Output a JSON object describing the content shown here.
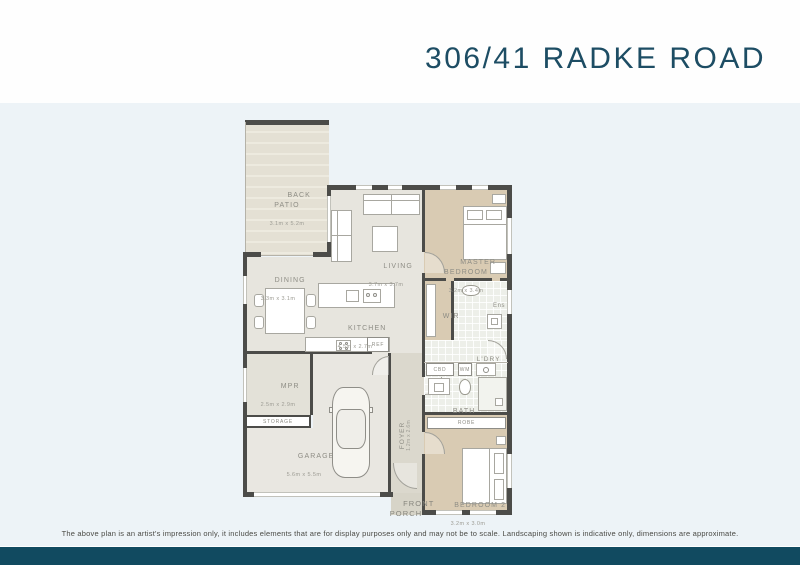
{
  "title": "306/41 RADKE ROAD",
  "disclaimer": "The above plan is an artist's impression only, it includes elements that are for display purposes only and may not be to scale. Landscaping shown is indicative only, dimensions are approximate.",
  "colors": {
    "accent_title": "#1d4d64",
    "footer_bar": "#114a60",
    "page_background": "#fefefe",
    "plan_background": "#edf3f7",
    "wall": "#4c4c49",
    "floor": "#e7e5de",
    "carpet": "#d9cbb3",
    "tile": "#edefe9",
    "deck": "#e4e0d4"
  },
  "rooms": {
    "back_patio": {
      "label": "BACK\nPATIO",
      "dims": "3.1m x 5.2m"
    },
    "living": {
      "label": "LIVING",
      "dims": "3.7m x 3.7m"
    },
    "dining": {
      "label": "DINING",
      "dims": "3.3m x 3.1m"
    },
    "kitchen": {
      "label": "KITCHEN",
      "dims": "4.5m x 2.7m"
    },
    "master_bedroom": {
      "label": "MASTER\nBEDROOM",
      "dims": "3.2m x 3.4m"
    },
    "wir": {
      "label": "WIR"
    },
    "ens": {
      "label": "Ens"
    },
    "ldry": {
      "label": "L'DRY"
    },
    "cbd": {
      "label": "CBD"
    },
    "wm": {
      "label": "WM"
    },
    "bath": {
      "label": "BATH"
    },
    "ref": {
      "label": "REF"
    },
    "mpr": {
      "label": "MPR",
      "dims": "2.5m x 2.9m"
    },
    "storage": {
      "label": "STORAGE"
    },
    "garage": {
      "label": "GARAGE",
      "dims": "5.6m x 5.5m"
    },
    "foyer": {
      "label": "FOYER",
      "dims": "1.2m x 2.6m"
    },
    "front_porch": {
      "label": "FRONT\nPORCH"
    },
    "robe": {
      "label": "ROBE"
    },
    "bedroom2": {
      "label": "BEDROOM 2",
      "dims": "3.2m x 3.0m"
    }
  }
}
